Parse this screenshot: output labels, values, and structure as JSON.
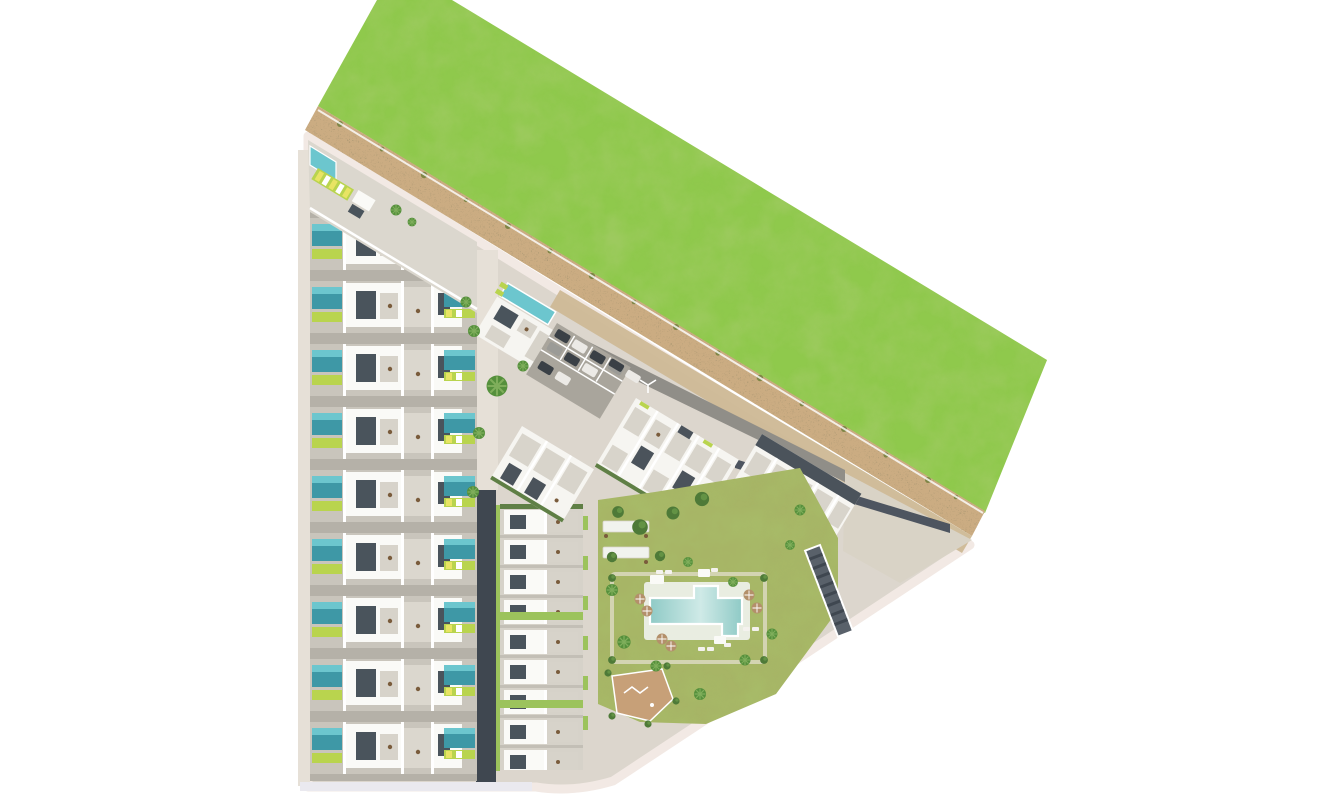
{
  "scene": {
    "description": "aerial-masterplan-render",
    "regions": {
      "grass_field": "undeveloped grass parcel (north-east)",
      "sand_path": "perimeter sand strip with shrubs",
      "terraced_houses_west": "west column of terraced houses with private pools",
      "terraced_houses_south": "south column of terraced houses",
      "clubhouse": "clubhouse with lap pool",
      "apartment_clusters": "three angled apartment blocks",
      "parking_lot": "car parking",
      "amenity_lawn": "communal garden with pool, pergolas, playground",
      "swimming_pool": "communal L-shaped pool",
      "playground": "sand playground",
      "solar_building": "dark technical building",
      "east_plaza": "east paved plaza"
    },
    "counts": {
      "terraced_rows_west": 9,
      "terraced_rows_south": 9,
      "apartment_clusters": 3,
      "parked_cars": 9,
      "pool_umbrellas": 6,
      "pergola_bars": 2
    }
  },
  "colors": {
    "bg": "#ffffff",
    "grass": "#8fc94c",
    "sand": "#cbac82",
    "sand_bush": "#77813f",
    "ground": "#dcd6cd",
    "ground_light": "#e6e0d7",
    "curb": "#f2e9e4",
    "plaza": "#d9d3c6",
    "inner_band": "#cdb996",
    "road_gray": "#908e88",
    "road_dark": "#3f4750",
    "road_dark_east": "#4e5560",
    "asphalt": "#a9a59c",
    "line_white": "#ffffff",
    "row_base": "#c9c5bc",
    "row_gap": "#b5b1a8",
    "row_base2": "#d6d2c9",
    "row_gap2": "#c3bfb6",
    "house_roof": "#fafaf7",
    "house_shadow": "#4a545c",
    "house_terrace": "#d7d3ca",
    "house_court": "#dbd7ce",
    "house_pool": "#3e98a6",
    "house_pool_light": "#6cc6ce",
    "lime": "#b9d44e",
    "lime_bright": "#e8e464",
    "hedge": "#5f7f45",
    "hedge_lime": "#9cc35c",
    "apt_white": "#f6f5f1",
    "apt_terrace": "#d8d4cb",
    "roof_dark": "#4b535b",
    "bar_dark": "#59616a",
    "bar_stripe": "#3f4750",
    "lawn": "#a7b566",
    "lawn_path": "#d3d4b2",
    "pool_deep": "#8fcac6",
    "pool_light": "#cfeae7",
    "deck": "#f1f3ee",
    "umbrella": "#b3906a",
    "lounger": "#f4f2ee",
    "palm": "#55903c",
    "palm_line": "#7fae5b",
    "tree_dark": "#4e7a38",
    "tree_mid": "#6b9c49",
    "play_sand": "#c7a078",
    "furniture": "#7a5c3c",
    "car_dark": "#3a4046",
    "car_white": "#eceae6",
    "car_gray": "#9b9b97",
    "bottom_road": "#eae9ef"
  }
}
